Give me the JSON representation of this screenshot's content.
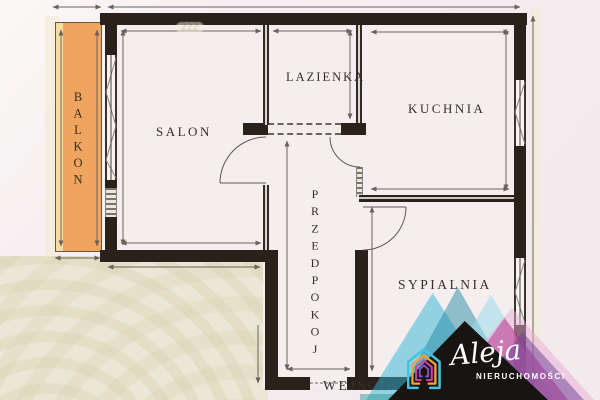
{
  "plan": {
    "rooms": {
      "balkon": {
        "label": "BALKON"
      },
      "salon": {
        "label": "SALON"
      },
      "lazienka": {
        "label": "LAZIENKA"
      },
      "kuchnia": {
        "label": "KUCHNIA"
      },
      "przedpokoj": {
        "label": "PRZEDPOKOJ"
      },
      "sypialnia": {
        "label": "SYPIALNIA"
      }
    },
    "entrance_label": "WEJŚCIE",
    "faded_dimension": "222"
  },
  "logo": {
    "brand": "Aleja",
    "subtitle": "NIERUCHOMOŚCI",
    "icon": "house-icon"
  },
  "colors": {
    "wall": "#2a211a",
    "floor": "#f4eeee",
    "background_pink": "#f4ebef",
    "background_beige": "#ebe7d6",
    "balcony_orange": "#efa55f",
    "dimension_gray": "#6b625a",
    "logo_black": "#171412",
    "logo_cyan": "#2fb4d4",
    "logo_teal": "#16809e",
    "logo_light_blue": "#9adced",
    "logo_magenta": "#c2368f",
    "logo_purple": "#6d3f96",
    "logo_text": "#ffffff"
  }
}
